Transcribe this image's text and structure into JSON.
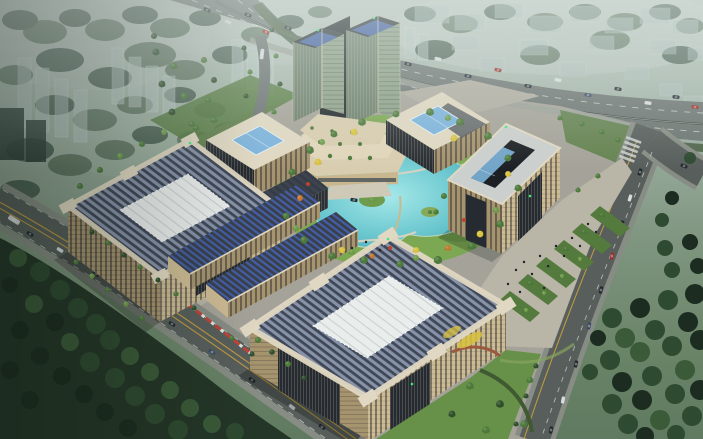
{
  "scene": {
    "type": "architectural-aerial-rendering",
    "description": "Dusk aerial rendering of a modern office campus: twin green-glass towers with a terraced podium, beige low-rise office blocks with blue striped roofs and white skylight courtyards arranged around a turquoise pond garden, a tree-lined plaza, perimeter roads with traffic, dark woodland corners, and a hazy city with an expressway behind.",
    "time_of_day": "hazy dusk",
    "counts": {
      "towers": 2,
      "large_courtyard_buildings": 3,
      "skylight_pavilions": 2,
      "annex_blocks": 2,
      "ponds": 1
    }
  },
  "colors": {
    "sky_haze": "#b9c4bd",
    "background_green": "#7f957f",
    "ghost_building": "#b7c8c3",
    "background_tree": "#42584a",
    "highway_asphalt": "#6e7673",
    "road_asphalt": "#575e5b",
    "sidewalk": "#878d84",
    "lane_yellow": "#c8a13e",
    "lane_white": "#d9ddd8",
    "campus_paving": "#a5a399",
    "plaza_paving": "#b9b5a7",
    "lawn": "#679048",
    "lawn_dark": "#557a3e",
    "garden_grass": "#7da853",
    "pond": "#62c4cc",
    "forest": "#243627",
    "tree_green": "#4c7a3a",
    "tree_light": "#6f9c4c",
    "tree_dark": "#2f4f2c",
    "tree_yellow": "#d8c33e",
    "tree_orange": "#c8782e",
    "facade_beige": "#cdbb94",
    "facade_beige_dark": "#a6946f",
    "facade_glass": "#262b31",
    "facade_dark": "#33383f",
    "roof_blue": "#8793a8",
    "roof_blue_dark": "#39404a",
    "roof_cream": "#e0d8c2",
    "roof_white": "#e9edec",
    "roof_gray": "#cbcfcd",
    "courtyard_dark": "#1c2024",
    "skylight_blue": "#7db4dc",
    "solar_blue": "#3f63b4",
    "tower_glass": "#8da087",
    "tower_glass_dark": "#6c7f6c",
    "tower_mullion": "#d3c9a9",
    "podium_cream": "#d9cdb0",
    "car_dark": "#23282e",
    "car_white": "#d6d9da",
    "car_red": "#9e2f28",
    "car_blue": "#3c4a63",
    "car_orange": "#b07c30",
    "barrier_red": "#c14338",
    "green_light": "#3fe87b",
    "people": "#1d2328"
  }
}
